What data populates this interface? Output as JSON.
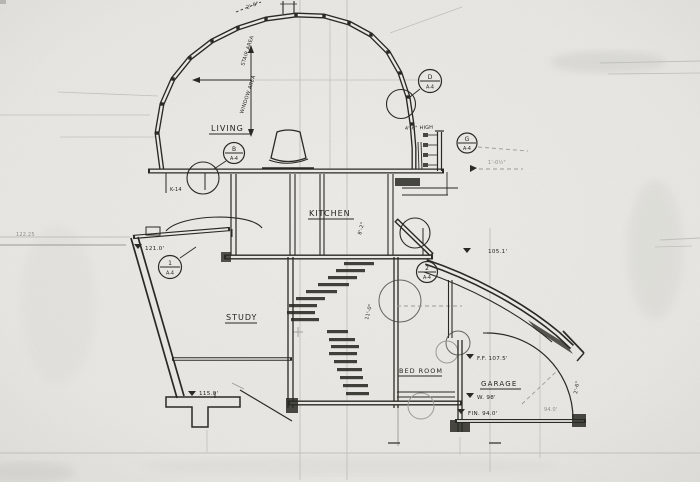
{
  "document": {
    "kind": "Scanned hand-drawn architectural building section",
    "sheet_ref": "A-4",
    "paper_color": "#e9e8e4",
    "ink_color": "#2a2a24",
    "pencil_color": "#9a9a96"
  },
  "rooms": {
    "living": "LIVING",
    "kitchen": "KITCHEN",
    "study": "STUDY",
    "bedroom": "BED ROOM",
    "garage": "GARAGE"
  },
  "bubbles": {
    "b": {
      "top": "B",
      "bottom": "A-4"
    },
    "d": {
      "top": "D",
      "bottom": "A-4"
    },
    "g": {
      "top": "G",
      "bottom": "A-4"
    },
    "n1": {
      "top": "1",
      "bottom": "A-4"
    },
    "n2": {
      "top": "2",
      "bottom": "A-4"
    }
  },
  "dimensions": {
    "dome_upper": "STAIR AREA",
    "dome_lower": "WINDOW AREA",
    "apex": "2'-0\"",
    "high_wall": "4'-6\" HIGH",
    "wall_offset": "1'-0½\"",
    "kitchen_height": "8'-2\"",
    "stair_height": "11'-0\"",
    "garage_height": "2'-6\"",
    "grid_ref": "K-14"
  },
  "elevations": {
    "left_margin": "122.25",
    "study_floor": "121.0'",
    "roof_edge": "105.1'",
    "footing": "115.0'",
    "bedroom_ff": "F.F. 107.5'",
    "garage_wall": "W. 98'",
    "garage_fin": "FIN. 94.0'",
    "garage_slab": "94.0'"
  }
}
